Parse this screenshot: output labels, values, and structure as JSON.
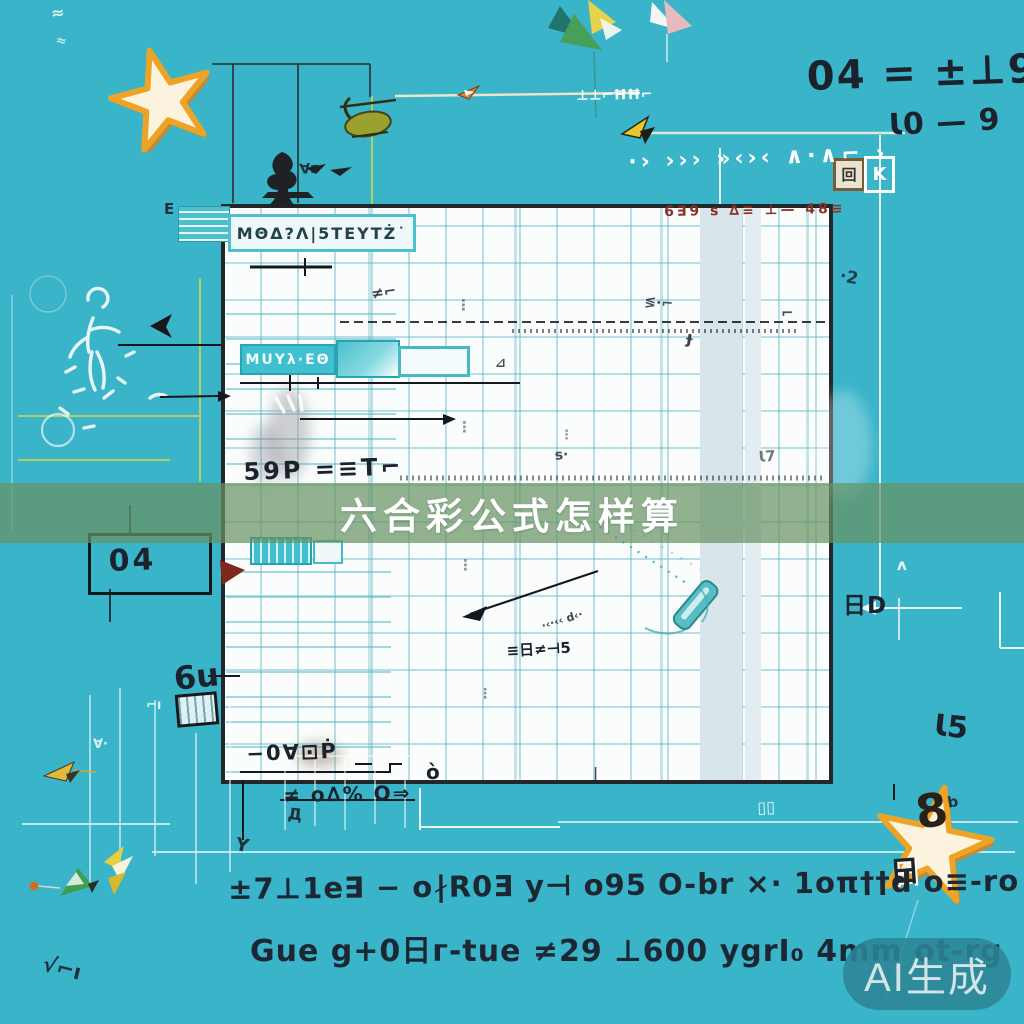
{
  "colors": {
    "background": "#39b4c9",
    "banner_overlay": "#68935f",
    "panel_paper": "#fafdfc",
    "grid_teal": "#56b6c6",
    "star_orange": "#eda426",
    "watermark_pill": "#2b8594",
    "ink_dark": "#1b222b",
    "ink_red": "#8a3124",
    "ui_teal": "#45b9c6"
  },
  "banner": {
    "title": "六合彩公式怎样算"
  },
  "watermark": {
    "label": "AI生成"
  },
  "panel": {
    "header_label": "ΜΘΔ?Λ|5ΤΕΥΤŻ˙",
    "red_note": "6∃9 s ∆≡ ⊥— 48≡",
    "teal_tag": "ΜUΥλ·ΕΘ",
    "code_59": "59Р =≡T⌐",
    "meter_label": "≡日≠⊣5",
    "bottom_code": "−0∀⊡Ṗ",
    "o_mark": "ò"
  },
  "annotations": {
    "eq_top": "04 = ±⊥9",
    "eq_mid": "Ɩ0 — 9",
    "chevron_row": "·› ››› »‹›‹ ∧·∧⌐ ›",
    "k_stamp": "回",
    "k_label": "K",
    "right_tag": "日D",
    "num_right": "Ɩ5",
    "box_04": "04",
    "glyph_6u": "6u",
    "under_panel": "≠ o∆% O⇒",
    "star_number": "8",
    "star_tag": "日",
    "formula_line1": "±7⊥1е∃ − o∤R0Ǝ y⊣ o95 O-br ×· 1oπ††d o≡-ro d∤ô",
    "formula_line2": "Guе g+0日г-tuе ≠29 ⊥600 ygrI₀ 4mm ot-rg"
  },
  "scatter": [
    {
      "t": "≈",
      "x": 50,
      "y": 4,
      "s": 16,
      "r": -6,
      "c": "w",
      "o": 0.85
    },
    {
      "t": "≈",
      "x": 57,
      "y": 33,
      "s": 13,
      "r": 10,
      "c": "w",
      "o": 0.75
    },
    {
      "t": "∀z·",
      "x": 299,
      "y": 162,
      "s": 14,
      "r": -5,
      "c": "d",
      "o": 0.9
    },
    {
      "t": "⊥⊥⌐ĦĦ⌐",
      "x": 576,
      "y": 88,
      "s": 14,
      "r": -1,
      "c": "w",
      "o": 0.95
    },
    {
      "t": "Ε",
      "x": 164,
      "y": 200,
      "s": 15,
      "r": 0,
      "c": "d",
      "o": 0.9
    },
    {
      "t": "·2",
      "x": 842,
      "y": 266,
      "s": 17,
      "r": 12,
      "c": "d",
      "o": 0.8
    },
    {
      "t": "⋮",
      "x": 456,
      "y": 296,
      "s": 15,
      "r": 0,
      "c": "g",
      "o": 0.8
    },
    {
      "t": "⋮",
      "x": 457,
      "y": 418,
      "s": 15,
      "r": 0,
      "c": "g",
      "o": 0.7
    },
    {
      "t": "⋮",
      "x": 458,
      "y": 556,
      "s": 15,
      "r": 0,
      "c": "g",
      "o": 0.7
    },
    {
      "t": "⋮",
      "x": 560,
      "y": 428,
      "s": 13,
      "r": 0,
      "c": "g",
      "o": 0.7
    },
    {
      "t": "⋮",
      "x": 478,
      "y": 686,
      "s": 14,
      "r": 0,
      "c": "g",
      "o": 0.75
    },
    {
      "t": "≠⌐",
      "x": 370,
      "y": 285,
      "s": 15,
      "r": -8,
      "c": "d",
      "o": 0.85
    },
    {
      "t": "≶·⌐",
      "x": 645,
      "y": 294,
      "s": 14,
      "r": 5,
      "c": "d",
      "o": 0.8
    },
    {
      "t": "⊿",
      "x": 495,
      "y": 356,
      "s": 13,
      "r": 0,
      "c": "d",
      "o": 0.8
    },
    {
      "t": "s⋅",
      "x": 554,
      "y": 448,
      "s": 14,
      "r": -6,
      "c": "d",
      "o": 0.8
    },
    {
      "t": "⌐",
      "x": 781,
      "y": 304,
      "s": 15,
      "r": 0,
      "c": "d",
      "o": 0.8
    },
    {
      "t": "ɟ",
      "x": 688,
      "y": 328,
      "s": 17,
      "r": 8,
      "c": "d",
      "o": 0.85
    },
    {
      "t": "Ɩ7",
      "x": 758,
      "y": 448,
      "s": 15,
      "r": -4,
      "c": "d",
      "o": 0.6
    },
    {
      "t": "·‹·‹‹ d‹·",
      "x": 540,
      "y": 620,
      "s": 11,
      "r": -17,
      "c": "d",
      "o": 0.85
    },
    {
      "t": "Y",
      "x": 238,
      "y": 834,
      "s": 18,
      "r": 12,
      "c": "d",
      "o": 0.9
    },
    {
      "t": "√⌐ı",
      "x": 46,
      "y": 952,
      "s": 21,
      "r": 14,
      "c": "d",
      "o": 0.9
    },
    {
      "t": "∀·",
      "x": 93,
      "y": 737,
      "s": 13,
      "r": 0,
      "c": "w",
      "o": 0.8
    },
    {
      "t": "⌐ı",
      "x": 146,
      "y": 698,
      "s": 13,
      "r": 0,
      "c": "w",
      "o": 0.8
    },
    {
      "t": "ʌ",
      "x": 897,
      "y": 556,
      "s": 15,
      "r": 0,
      "c": "w",
      "o": 0.9
    },
    {
      "t": "Д",
      "x": 289,
      "y": 804,
      "s": 16,
      "r": 6,
      "c": "d",
      "o": 0.9
    },
    {
      "t": "|",
      "x": 593,
      "y": 766,
      "s": 14,
      "r": 0,
      "c": "d",
      "o": 0.8
    },
    {
      "t": "b",
      "x": 946,
      "y": 794,
      "s": 15,
      "r": -10,
      "c": "d",
      "o": 0.85
    },
    {
      "t": "▯▯",
      "x": 757,
      "y": 798,
      "s": 16,
      "r": -2,
      "c": "w",
      "o": 0.9
    }
  ]
}
